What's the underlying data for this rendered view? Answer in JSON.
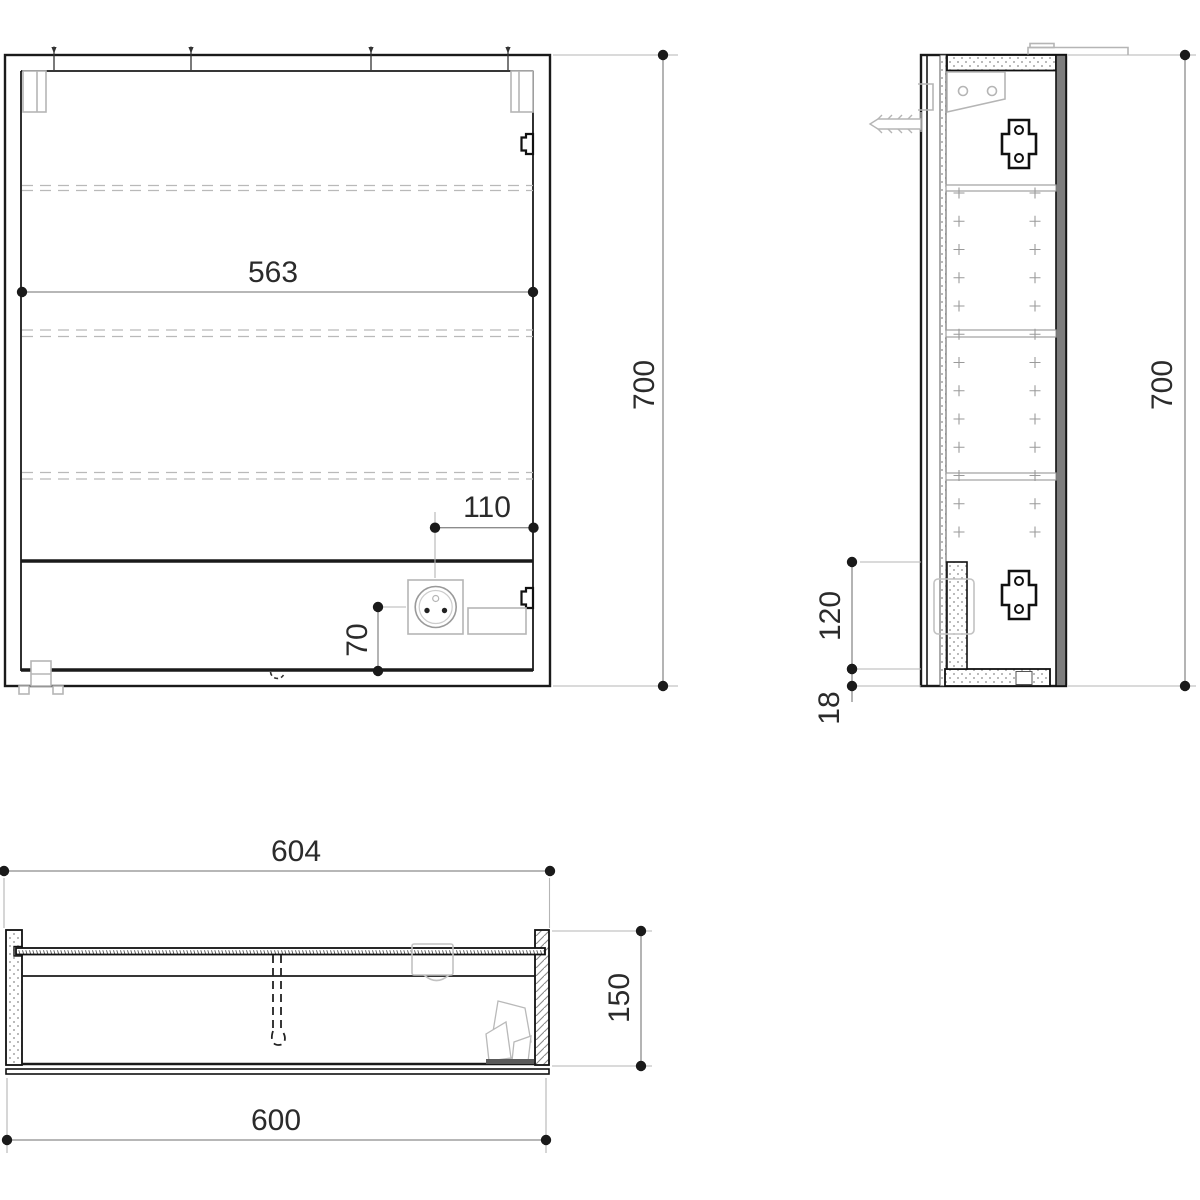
{
  "drawing": {
    "type": "technical-cad-drawing",
    "subject": "mirror-cabinet-three-views",
    "colors": {
      "background": "#ffffff",
      "line": "#1a1a1a",
      "dim_line": "#8c8c8c",
      "detail_gray": "#b5b5b5",
      "text": "#2b2b2b"
    },
    "dims": {
      "front_inner_width": "563",
      "front_height": "700",
      "socket_from_right": "110",
      "socket_from_bottom": "70",
      "side_height": "700",
      "lamp_compartment_height": "120",
      "bottom_panel_thickness": "18",
      "door_width": "604",
      "cabinet_depth": "150",
      "carcass_width": "600"
    }
  }
}
